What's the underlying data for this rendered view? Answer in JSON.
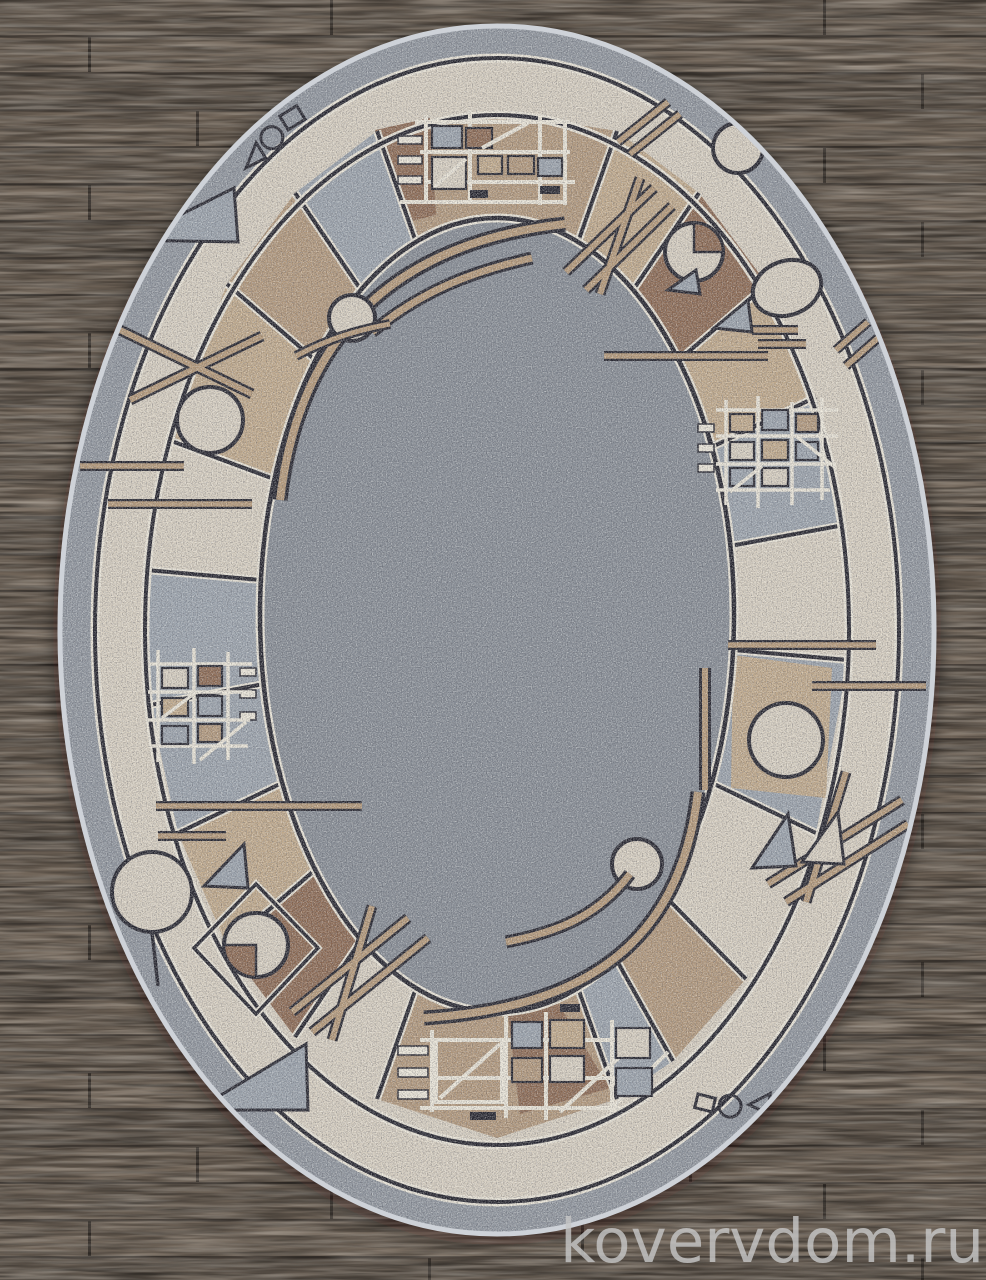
{
  "scene": {
    "description": "Oval machine-woven rug with a geometric patchwork border (squares, grids, circles, pie-circles, triangles and bars in beige, brown and blue-grey) on a speckled grey field, lying on a dark wooden plank floor",
    "rug_shape": "oval",
    "floor": "wood planks"
  },
  "watermark": {
    "text": "kovervdom.ru"
  },
  "palette": {
    "wood_base": "#6d6257",
    "wood_gap": "#4b433c",
    "field": "#848a93",
    "gray_band": "#8e949d",
    "bluegray": "#99a1ab",
    "cream": "#d6cec0",
    "tan": "#bfa88a",
    "tan2": "#b0967a",
    "brown": "#8a6750",
    "dark": "#20202a",
    "light": "#e9e4d7",
    "bar": "#b49878",
    "edge": "#ced2d8",
    "watermark": "#c6c6c6"
  }
}
